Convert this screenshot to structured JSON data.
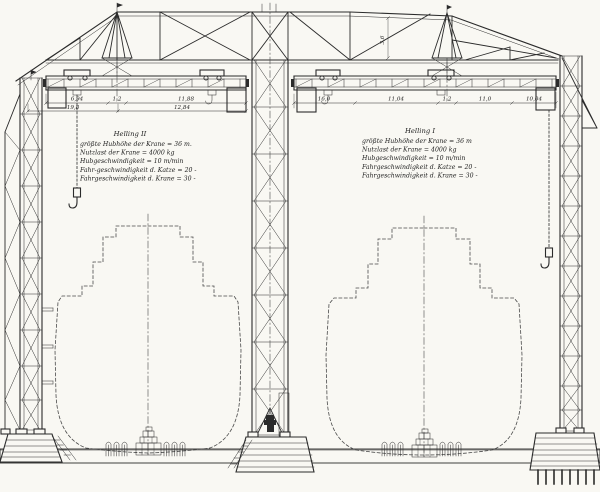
{
  "drawing_type": "gantry-crane-elevation",
  "colors": {
    "ink": "#2b2b2b",
    "paper": "#f9f8f3"
  },
  "specs": {
    "left": {
      "title": "Helling II",
      "lines": [
        "größte Hubhöhe der Krane = 36 m.",
        "Nutzlast der Krane = 4000 kg",
        "Hubgeschwindigkeit  = 10 m/min",
        "Fahr-geschwindigkeit d. Katze = 20  -",
        "Fahrgeschwindigkeit d. Krane = 30  -"
      ]
    },
    "right": {
      "title": "Helling I",
      "lines": [
        "größte Hubhöhe der Krane = 36 m",
        "Nutzlast der Krane = 4000 kg",
        "Hubgeschwindigkeit  = 10 m/min",
        "Fahrgeschwindigkeit d. Katze = 20  -",
        "Fahrgeschwindigkeit d. Krane = 30  -"
      ]
    }
  },
  "dims": {
    "left": [
      "6,94",
      "1,2",
      "11,88",
      "19,8",
      "12,84"
    ],
    "right": [
      "16,0",
      "11,04",
      "1,2",
      "11,0",
      "10,04"
    ],
    "truss_height": "3,6"
  }
}
